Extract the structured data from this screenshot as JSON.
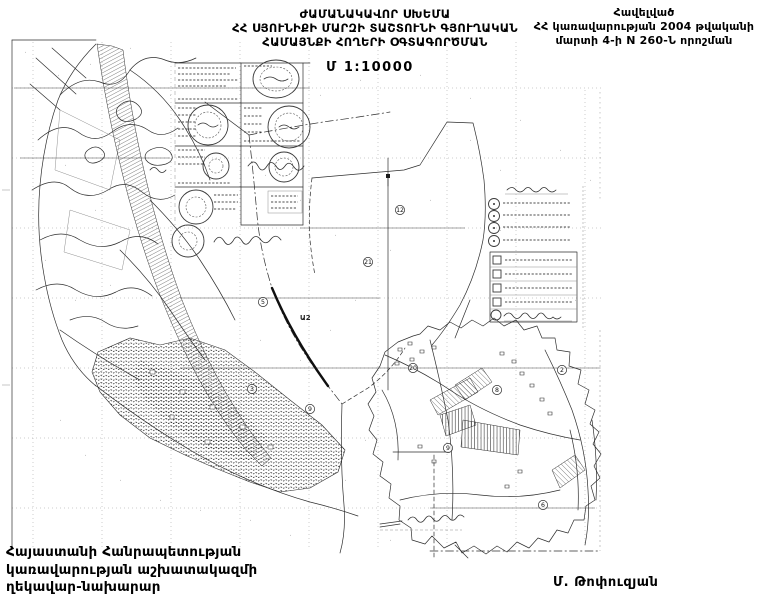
{
  "document": {
    "title": [
      "ԺԱՄԱՆԱԿԱՎՈՐ ՍԽԵՄԱ",
      "ՀՀ ՍՅՈՒՆԻՔԻ ՄԱՐԶԻ ՏԱՇՏՈՒՆԻ ԳՅՈՒՂԱԿԱՆ",
      "ՀԱՄԱՅՆՔԻ ՀՈՂԵՐԻ ՕԳՏԱԳՈՐԾՄԱՆ"
    ],
    "scale_label": "Մ 1:10000",
    "appendix": [
      "Հավելված",
      "ՀՀ կառավարության 2004 թվականի",
      "մարտի 4-ի N 260-Ն որոշման"
    ],
    "signatory": [
      "Հայաստանի Հանրապետության",
      "կառավարության աշխատակազմի",
      "ղեկավար-նախարար"
    ],
    "signature_name": "Մ. Թոփուզյան"
  },
  "map": {
    "area_label": "Ա2",
    "parcel_markers": [
      {
        "label": "5",
        "x": 263,
        "y": 302
      },
      {
        "label": "21",
        "x": 368,
        "y": 262
      },
      {
        "label": "12",
        "x": 400,
        "y": 210
      },
      {
        "label": "3",
        "x": 252,
        "y": 389
      },
      {
        "label": "9",
        "x": 310,
        "y": 409
      },
      {
        "label": "20",
        "x": 413,
        "y": 368
      },
      {
        "label": "9",
        "x": 448,
        "y": 448
      },
      {
        "label": "8",
        "x": 497,
        "y": 390
      },
      {
        "label": "2",
        "x": 562,
        "y": 370
      },
      {
        "label": "6",
        "x": 543,
        "y": 505
      }
    ],
    "colors": {
      "ink": "#2e2e2e",
      "paper": "#ffffff"
    }
  }
}
